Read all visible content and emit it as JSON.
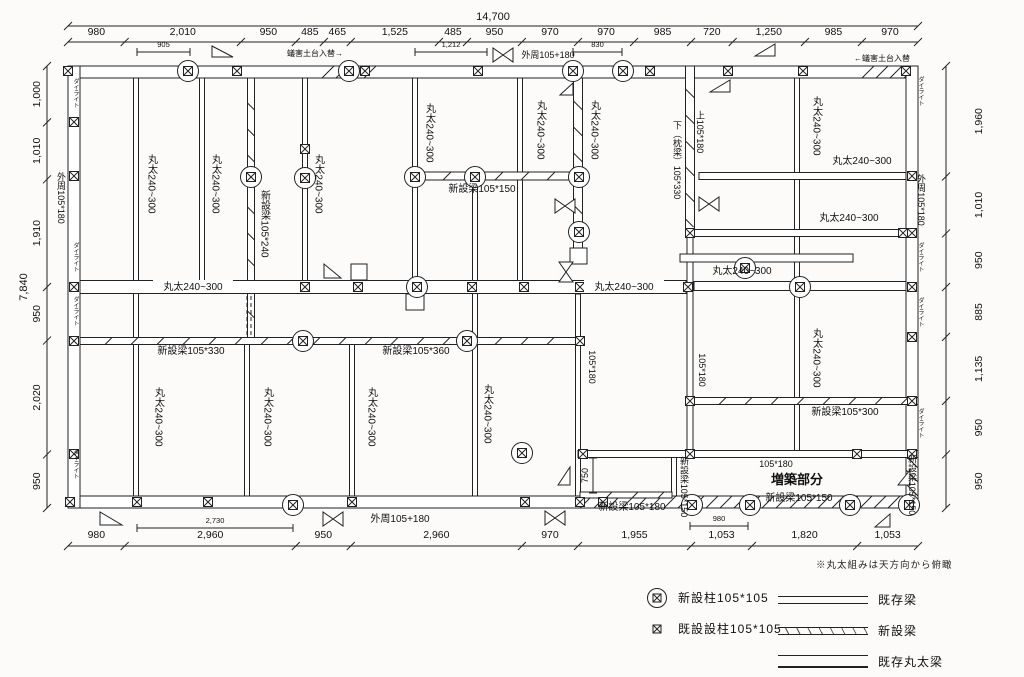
{
  "legend": {
    "note": "※丸太組みは天方向から俯瞰",
    "posts": [
      {
        "type": "circled",
        "label": "新設柱105*105"
      },
      {
        "type": "plain",
        "label": "既設設柱105*105"
      }
    ],
    "lines": [
      {
        "type": "double",
        "label": "既存梁"
      },
      {
        "type": "hatched",
        "label": "新設梁"
      },
      {
        "type": "log",
        "label": "既存丸太梁"
      }
    ]
  },
  "dimensions": {
    "top_total": {
      "label": "14,700"
    },
    "left_total": {
      "label": "7,840"
    },
    "top": [
      {
        "label": "980",
        "mm": 980
      },
      {
        "label": "2,010",
        "mm": 2010
      },
      {
        "label": "950",
        "mm": 950
      },
      {
        "label": "485",
        "mm": 485
      },
      {
        "label": "465",
        "mm": 465
      },
      {
        "label": "1,525",
        "mm": 1525
      },
      {
        "label": "485",
        "mm": 485
      },
      {
        "label": "950",
        "mm": 950
      },
      {
        "label": "970",
        "mm": 970
      },
      {
        "label": "970",
        "mm": 970
      },
      {
        "label": "985",
        "mm": 985
      },
      {
        "label": "720",
        "mm": 720
      },
      {
        "label": "1,250",
        "mm": 1250
      },
      {
        "label": "985",
        "mm": 985
      },
      {
        "label": "970",
        "mm": 970
      }
    ],
    "bottom": [
      {
        "label": "980",
        "mm": 980
      },
      {
        "label": "2,960",
        "mm": 2960
      },
      {
        "label": "950",
        "mm": 950
      },
      {
        "label": "2,960",
        "mm": 2960
      },
      {
        "label": "970",
        "mm": 970
      },
      {
        "label": "1,955",
        "mm": 1955
      },
      {
        "label": "1,053",
        "mm": 1053
      },
      {
        "label": "1,820",
        "mm": 1820
      },
      {
        "label": "1,053",
        "mm": 1053
      }
    ],
    "left": [
      {
        "label": "1,000",
        "mm": 1000
      },
      {
        "label": "1,010",
        "mm": 1010
      },
      {
        "label": "1,910",
        "mm": 1910
      },
      {
        "label": "950",
        "mm": 950
      },
      {
        "label": "2,020",
        "mm": 2020
      },
      {
        "label": "950",
        "mm": 950
      }
    ],
    "right": [
      {
        "label": "1,960",
        "mm": 1960
      },
      {
        "label": "1,010",
        "mm": 1010
      },
      {
        "label": "950",
        "mm": 950
      },
      {
        "label": "885",
        "mm": 885
      },
      {
        "label": "1,135",
        "mm": 1135
      },
      {
        "label": "950",
        "mm": 950
      },
      {
        "label": "950",
        "mm": 950
      }
    ],
    "sub": [
      {
        "o": "h",
        "x1": 137,
        "x2": 190,
        "y": 52,
        "label": "905"
      },
      {
        "o": "h",
        "x1": 415,
        "x2": 487,
        "y": 52,
        "label": "1,212"
      },
      {
        "o": "h",
        "x1": 573,
        "x2": 622,
        "y": 52,
        "label": "830"
      },
      {
        "o": "h",
        "x1": 137,
        "x2": 293,
        "y": 528,
        "label": "2,730"
      },
      {
        "o": "h",
        "x1": 690,
        "x2": 748,
        "y": 526,
        "label": "980"
      },
      {
        "o": "v",
        "y1": 458,
        "y2": 493,
        "x": 593,
        "label": "750"
      }
    ]
  },
  "drawing": {
    "colors": {
      "line": "#222",
      "text": "#111",
      "fill": "#ffffff"
    },
    "walls": [
      {
        "x": 68,
        "y": 66,
        "w": 850,
        "h": 12
      },
      {
        "x": 68,
        "y": 496,
        "w": 850,
        "h": 12
      },
      {
        "x": 68,
        "y": 66,
        "w": 12,
        "h": 442
      },
      {
        "x": 906,
        "y": 66,
        "w": 12,
        "h": 442
      }
    ],
    "wall_hatches": [
      {
        "x": 578,
        "y": 496,
        "w": 340,
        "h": 12
      },
      {
        "x": 906,
        "y": 454,
        "w": 12,
        "h": 54
      },
      {
        "x": 320,
        "y": 66,
        "w": 56,
        "h": 12
      },
      {
        "x": 860,
        "y": 66,
        "w": 46,
        "h": 12
      }
    ],
    "beams": [
      {
        "o": "v",
        "x": 136,
        "a": 78,
        "b": 496,
        "w": 5,
        "t": "log"
      },
      {
        "o": "v",
        "x": 202,
        "a": 78,
        "b": 281,
        "w": 5,
        "t": "log"
      },
      {
        "o": "v",
        "x": 251,
        "a": 78,
        "b": 338,
        "w": 7,
        "t": "new"
      },
      {
        "o": "v",
        "x": 305,
        "a": 78,
        "b": 281,
        "w": 5,
        "t": "log"
      },
      {
        "o": "v",
        "x": 415,
        "a": 78,
        "b": 294,
        "w": 5,
        "t": "log"
      },
      {
        "o": "v",
        "x": 520,
        "a": 78,
        "b": 281,
        "w": 5,
        "t": "log"
      },
      {
        "o": "v",
        "x": 578,
        "a": 78,
        "b": 248,
        "w": 9,
        "t": "new"
      },
      {
        "o": "v",
        "x": 690,
        "a": 66,
        "b": 233,
        "w": 9,
        "t": "new"
      },
      {
        "o": "v",
        "x": 690,
        "a": 233,
        "b": 451,
        "w": 6,
        "t": "log"
      },
      {
        "o": "v",
        "x": 797,
        "a": 78,
        "b": 451,
        "w": 5,
        "t": "log"
      },
      {
        "o": "v",
        "x": 247,
        "a": 344,
        "b": 496,
        "w": 5,
        "t": "log"
      },
      {
        "o": "v",
        "x": 352,
        "a": 344,
        "b": 496,
        "w": 5,
        "t": "log"
      },
      {
        "o": "v",
        "x": 475,
        "a": 182,
        "b": 496,
        "w": 5,
        "t": "log"
      },
      {
        "o": "v",
        "x": 578,
        "a": 294,
        "b": 496,
        "w": 5,
        "t": "log"
      },
      {
        "o": "v",
        "x": 674,
        "a": 457,
        "b": 496,
        "w": 5,
        "t": "log"
      },
      {
        "o": "h",
        "y": 176,
        "a": 419,
        "b": 574,
        "w": 8,
        "t": "new"
      },
      {
        "o": "h",
        "y": 176,
        "a": 699,
        "b": 906,
        "w": 7,
        "t": "log"
      },
      {
        "o": "h",
        "y": 233,
        "a": 694,
        "b": 906,
        "w": 7,
        "t": "log"
      },
      {
        "o": "h",
        "y": 258,
        "a": 680,
        "b": 853,
        "w": 8,
        "t": "log"
      },
      {
        "o": "h",
        "y": 287,
        "a": 80,
        "b": 686,
        "w": 13,
        "t": "log"
      },
      {
        "o": "h",
        "y": 286,
        "a": 694,
        "b": 906,
        "w": 9,
        "t": "log"
      },
      {
        "o": "h",
        "y": 341,
        "a": 80,
        "b": 578,
        "w": 7,
        "t": "new"
      },
      {
        "o": "h",
        "y": 401,
        "a": 694,
        "b": 918,
        "w": 7,
        "t": "new"
      },
      {
        "o": "h",
        "y": 454,
        "a": 578,
        "b": 918,
        "w": 7,
        "t": "log"
      },
      {
        "o": "h",
        "y": 495,
        "a": 580,
        "b": 672,
        "w": 6,
        "t": "new"
      }
    ],
    "dashes": [
      {
        "x": 249,
        "y1": 296,
        "y2": 338
      }
    ],
    "blocks": [
      {
        "x": 406,
        "y": 294,
        "w": 18,
        "h": 16
      },
      {
        "x": 570,
        "y": 248,
        "w": 17,
        "h": 16
      },
      {
        "x": 351,
        "y": 264,
        "w": 16,
        "h": 16
      }
    ],
    "posts_plain": [
      [
        68,
        71
      ],
      [
        237,
        71
      ],
      [
        478,
        71
      ],
      [
        650,
        71
      ],
      [
        728,
        71
      ],
      [
        803,
        71
      ],
      [
        906,
        71
      ],
      [
        365,
        71
      ],
      [
        74,
        122
      ],
      [
        74,
        176
      ],
      [
        74,
        287
      ],
      [
        74,
        341
      ],
      [
        74,
        454
      ],
      [
        912,
        176
      ],
      [
        912,
        233
      ],
      [
        912,
        287
      ],
      [
        912,
        337
      ],
      [
        912,
        401
      ],
      [
        912,
        454
      ],
      [
        70,
        502
      ],
      [
        137,
        502
      ],
      [
        208,
        502
      ],
      [
        352,
        502
      ],
      [
        525,
        502
      ],
      [
        580,
        502
      ],
      [
        603,
        502
      ],
      [
        305,
        149
      ],
      [
        305,
        287
      ],
      [
        358,
        287
      ],
      [
        472,
        287
      ],
      [
        524,
        287
      ],
      [
        580,
        287
      ],
      [
        688,
        287
      ],
      [
        580,
        341
      ],
      [
        690,
        233
      ],
      [
        903,
        233
      ],
      [
        690,
        401
      ],
      [
        583,
        454
      ],
      [
        690,
        454
      ],
      [
        857,
        454
      ]
    ],
    "posts_circled": [
      [
        188,
        71
      ],
      [
        349,
        71
      ],
      [
        573,
        71
      ],
      [
        623,
        71
      ],
      [
        251,
        177
      ],
      [
        305,
        178
      ],
      [
        415,
        177
      ],
      [
        475,
        177
      ],
      [
        579,
        177
      ],
      [
        579,
        232
      ],
      [
        745,
        268
      ],
      [
        417,
        287
      ],
      [
        800,
        287
      ],
      [
        303,
        341
      ],
      [
        467,
        341
      ],
      [
        522,
        453
      ],
      [
        293,
        505
      ],
      [
        692,
        505
      ],
      [
        750,
        505
      ],
      [
        850,
        505
      ],
      [
        909,
        505
      ]
    ],
    "triangles": [
      [
        212,
        46,
        212,
        57,
        233,
        57
      ],
      [
        755,
        56,
        775,
        44,
        775,
        56
      ],
      [
        710,
        92,
        730,
        80,
        730,
        92
      ],
      [
        324,
        264,
        324,
        278,
        341,
        278
      ],
      [
        558,
        485,
        570,
        467,
        570,
        485
      ],
      [
        100,
        512,
        100,
        525,
        122,
        525
      ],
      [
        875,
        527,
        890,
        514,
        890,
        527
      ],
      [
        898,
        485,
        910,
        470,
        910,
        485
      ],
      [
        560,
        95,
        573,
        83,
        573,
        95
      ]
    ],
    "bowties_h": [
      [
        503,
        55
      ],
      [
        333,
        519
      ],
      [
        555,
        518
      ],
      [
        709,
        204
      ],
      [
        565,
        206
      ]
    ],
    "bowties_v": [
      [
        566,
        272
      ]
    ],
    "labels": [
      {
        "t": "蟻害土台入替→",
        "x": 315,
        "y": 56,
        "s": 8
      },
      {
        "t": "外周105+180",
        "x": 548,
        "y": 58,
        "s": 9
      },
      {
        "t": "←蟻害土台入替",
        "x": 882,
        "y": 61,
        "s": 8
      },
      {
        "t": "新設梁105*150",
        "x": 482,
        "y": 192,
        "s": 10
      },
      {
        "t": "丸太240~300",
        "x": 862,
        "y": 164,
        "s": 10
      },
      {
        "t": "丸太240~300",
        "x": 849,
        "y": 221,
        "s": 10
      },
      {
        "t": "丸太240~300",
        "x": 742,
        "y": 274,
        "s": 10
      },
      {
        "t": "丸太240~300",
        "x": 193,
        "y": 290,
        "s": 10,
        "bg": 1
      },
      {
        "t": "丸太240~300",
        "x": 624,
        "y": 290,
        "s": 10,
        "bg": 1
      },
      {
        "t": "新設梁105*330",
        "x": 191,
        "y": 354,
        "s": 10
      },
      {
        "t": "新設梁105*360",
        "x": 416,
        "y": 354,
        "s": 10
      },
      {
        "t": "新設梁105*300",
        "x": 845,
        "y": 415,
        "s": 10
      },
      {
        "t": "105*180",
        "x": 776,
        "y": 467,
        "s": 9
      },
      {
        "t": "増築部分",
        "x": 797,
        "y": 484,
        "s": 13,
        "b": 1
      },
      {
        "t": "新設梁105*150",
        "x": 799,
        "y": 501,
        "s": 10
      },
      {
        "t": "新設梁105*180",
        "x": 632,
        "y": 510,
        "s": 10
      },
      {
        "t": "外周105+180",
        "x": 400,
        "y": 522,
        "s": 10
      },
      {
        "t": "外周105*180",
        "x": 61,
        "y": 198,
        "s": 9,
        "v": 1
      },
      {
        "t": "外周105*180",
        "x": 921,
        "y": 200,
        "s": 9,
        "v": 1
      },
      {
        "t": "ダイライト",
        "x": 75,
        "y": 93,
        "s": 6,
        "v": 1
      },
      {
        "t": "ダイライト",
        "x": 75,
        "y": 257,
        "s": 6,
        "v": 1
      },
      {
        "t": "ダイライト",
        "x": 75,
        "y": 311,
        "s": 6,
        "v": 1
      },
      {
        "t": "ダイライト",
        "x": 75,
        "y": 464,
        "s": 6,
        "v": 1
      },
      {
        "t": "ダイライト",
        "x": 920,
        "y": 91,
        "s": 6,
        "v": 1
      },
      {
        "t": "ダイライト",
        "x": 920,
        "y": 257,
        "s": 6,
        "v": 1
      },
      {
        "t": "ダイライト",
        "x": 920,
        "y": 312,
        "s": 6,
        "v": 1
      },
      {
        "t": "ダイライト",
        "x": 920,
        "y": 423,
        "s": 6,
        "v": 1
      },
      {
        "t": "丸太240~300",
        "x": 151,
        "y": 184,
        "s": 10,
        "v": 1
      },
      {
        "t": "丸太240~300",
        "x": 215,
        "y": 184,
        "s": 10,
        "v": 1
      },
      {
        "t": "新設梁105*240",
        "x": 264,
        "y": 224,
        "s": 10,
        "v": 1
      },
      {
        "t": "丸太240~300",
        "x": 318,
        "y": 184,
        "s": 10,
        "v": 1
      },
      {
        "t": "丸太240~300",
        "x": 429,
        "y": 133,
        "s": 10,
        "v": 1
      },
      {
        "t": "丸太240~300",
        "x": 540,
        "y": 130,
        "s": 10,
        "v": 1
      },
      {
        "t": "丸太240~300",
        "x": 594,
        "y": 130,
        "s": 10,
        "v": 1
      },
      {
        "t": "下（枕梁）105*330",
        "x": 677,
        "y": 160,
        "s": 9,
        "v": 1
      },
      {
        "t": "上105*180",
        "x": 700,
        "y": 132,
        "s": 9,
        "v": 1
      },
      {
        "t": "丸太240~300",
        "x": 816,
        "y": 126,
        "s": 10,
        "v": 1
      },
      {
        "t": "丸太240~300",
        "x": 816,
        "y": 358,
        "s": 10,
        "v": 1
      },
      {
        "t": "105*180",
        "x": 592,
        "y": 367,
        "s": 9,
        "v": 1
      },
      {
        "t": "105*180",
        "x": 702,
        "y": 370,
        "s": 9,
        "v": 1
      },
      {
        "t": "丸太240~300",
        "x": 158,
        "y": 417,
        "s": 10,
        "v": 1
      },
      {
        "t": "丸太240~300",
        "x": 267,
        "y": 417,
        "s": 10,
        "v": 1
      },
      {
        "t": "丸太240~300",
        "x": 371,
        "y": 417,
        "s": 10,
        "v": 1
      },
      {
        "t": "丸太240~300",
        "x": 487,
        "y": 414,
        "s": 10,
        "v": 1
      },
      {
        "t": "新設梁105*150",
        "x": 684,
        "y": 487,
        "s": 9,
        "v": 1
      },
      {
        "t": "新設梁105*150",
        "x": 912,
        "y": 485,
        "s": 9,
        "v": 1
      }
    ]
  }
}
